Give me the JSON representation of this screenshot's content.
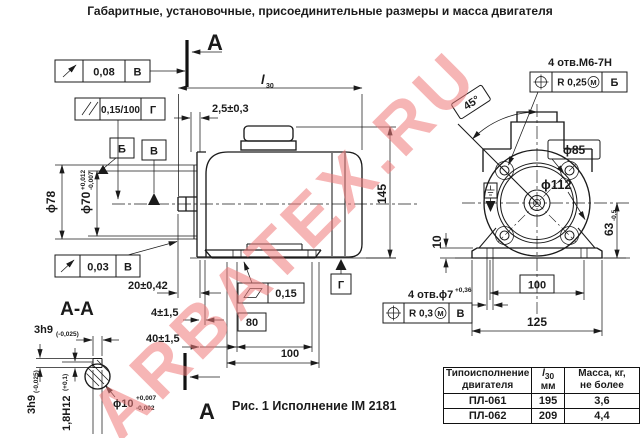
{
  "title": "Габаритные, установочные, присоединительные размеры и масса двигателя",
  "caption": "Рис. 1 Исполнение IM 2181",
  "watermark": "ARBATEX.RU",
  "section_marks": {
    "label": "А",
    "view_title": "А-А"
  },
  "datums": {
    "b": "Б",
    "v": "В",
    "g": "Г"
  },
  "frames": {
    "runout_top": {
      "value": "0,08",
      "datum": "В"
    },
    "parallelism": {
      "value": "0,15/100",
      "datum": "Г"
    },
    "runout_bottom": {
      "value": "0,03",
      "datum": "В"
    },
    "flatness": {
      "value": "0,15"
    },
    "position_m6": {
      "value": "R 0,25",
      "modifier": "М",
      "datum": "Б"
    },
    "position_7": {
      "value": "R 0,3",
      "modifier": "М",
      "datum": "В"
    }
  },
  "side_dims": {
    "l30_main": "l",
    "l30_sub": "30",
    "flange_gap": "2,5±0,3",
    "shaft_len": "20±0,42",
    "foot_offset": "4±1,5",
    "hole_offset": "40±1,5",
    "hole_span": "80",
    "foot_len": "100",
    "height": "145",
    "d78": "ϕ78",
    "d70": "ϕ70",
    "d70_up": "+0,012",
    "d70_dn": "-0,007"
  },
  "front_dims": {
    "holes_label": "4 отв.М6-7Н",
    "angle": "45°",
    "d85": "ϕ85",
    "d112": "ϕ112",
    "pad_h": "10",
    "axis_h": "63",
    "axis_h_tol": "-0,5",
    "hole_span": "100",
    "base_len": "125",
    "foot_holes_label": "4 отв.ϕ7",
    "foot_holes_tol": "+0,36"
  },
  "section_dims": {
    "key_w": "3h9",
    "key_w_tol": "(-0,025)",
    "key_h": "1,8H12",
    "key_h_tol": "(+0,1)",
    "shaft_d": "ϕ10",
    "shaft_d_up": "+0,007",
    "shaft_d_dn": "-0,002"
  },
  "table": {
    "headers": {
      "col1_l1": "Типоисполнение",
      "col1_l2": "двигателя",
      "col2_main": "l",
      "col2_sub": "30",
      "col2_l2": "мм",
      "col3_l1": "Масса, кг,",
      "col3_l2": "не более"
    },
    "rows": [
      [
        "ПЛ-061",
        "195",
        "3,6"
      ],
      [
        "ПЛ-062",
        "209",
        "4,4"
      ]
    ]
  },
  "colors": {
    "ink": "#1b1b1b",
    "watermark": "#ef7a7a"
  }
}
